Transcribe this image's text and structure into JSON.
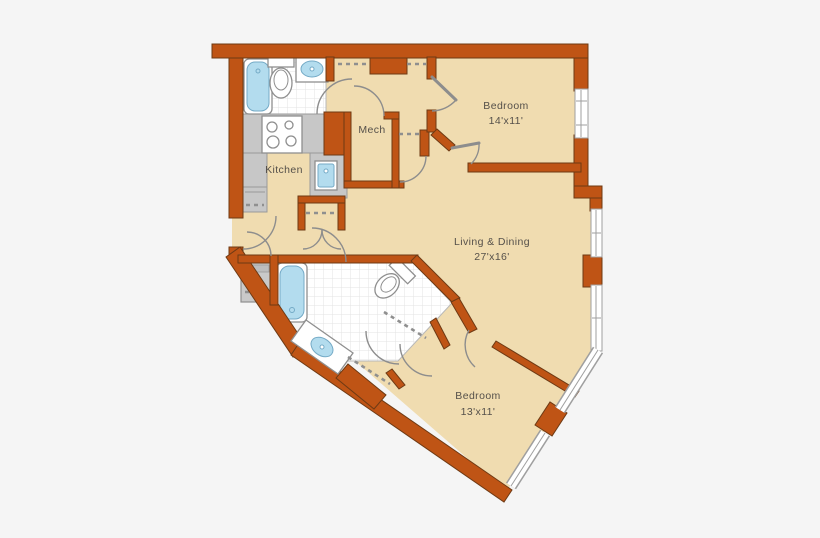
{
  "floorplan": {
    "labels": {
      "bedroom_top": {
        "name": "Bedroom",
        "dims": "14'x11'"
      },
      "living": {
        "name": "Living & Dining",
        "dims": "27'x16'"
      },
      "bedroom_bottom": {
        "name": "Bedroom",
        "dims": "13'x11'"
      },
      "kitchen": {
        "name": "Kitchen"
      },
      "mech": {
        "name": "Mech"
      }
    },
    "colors": {
      "background": "#f5f5f5",
      "wall": "#bf5415",
      "wall_outline": "#6e3a14",
      "floor": "#f0dcb0",
      "tile": "#ffffff",
      "tile_line": "#e3e3e3",
      "counter": "#c7c7c7",
      "fixture_outline": "#8f8f8f",
      "water": "#b3dcee",
      "door": "#8d8d8d",
      "text": "#55504a"
    }
  }
}
